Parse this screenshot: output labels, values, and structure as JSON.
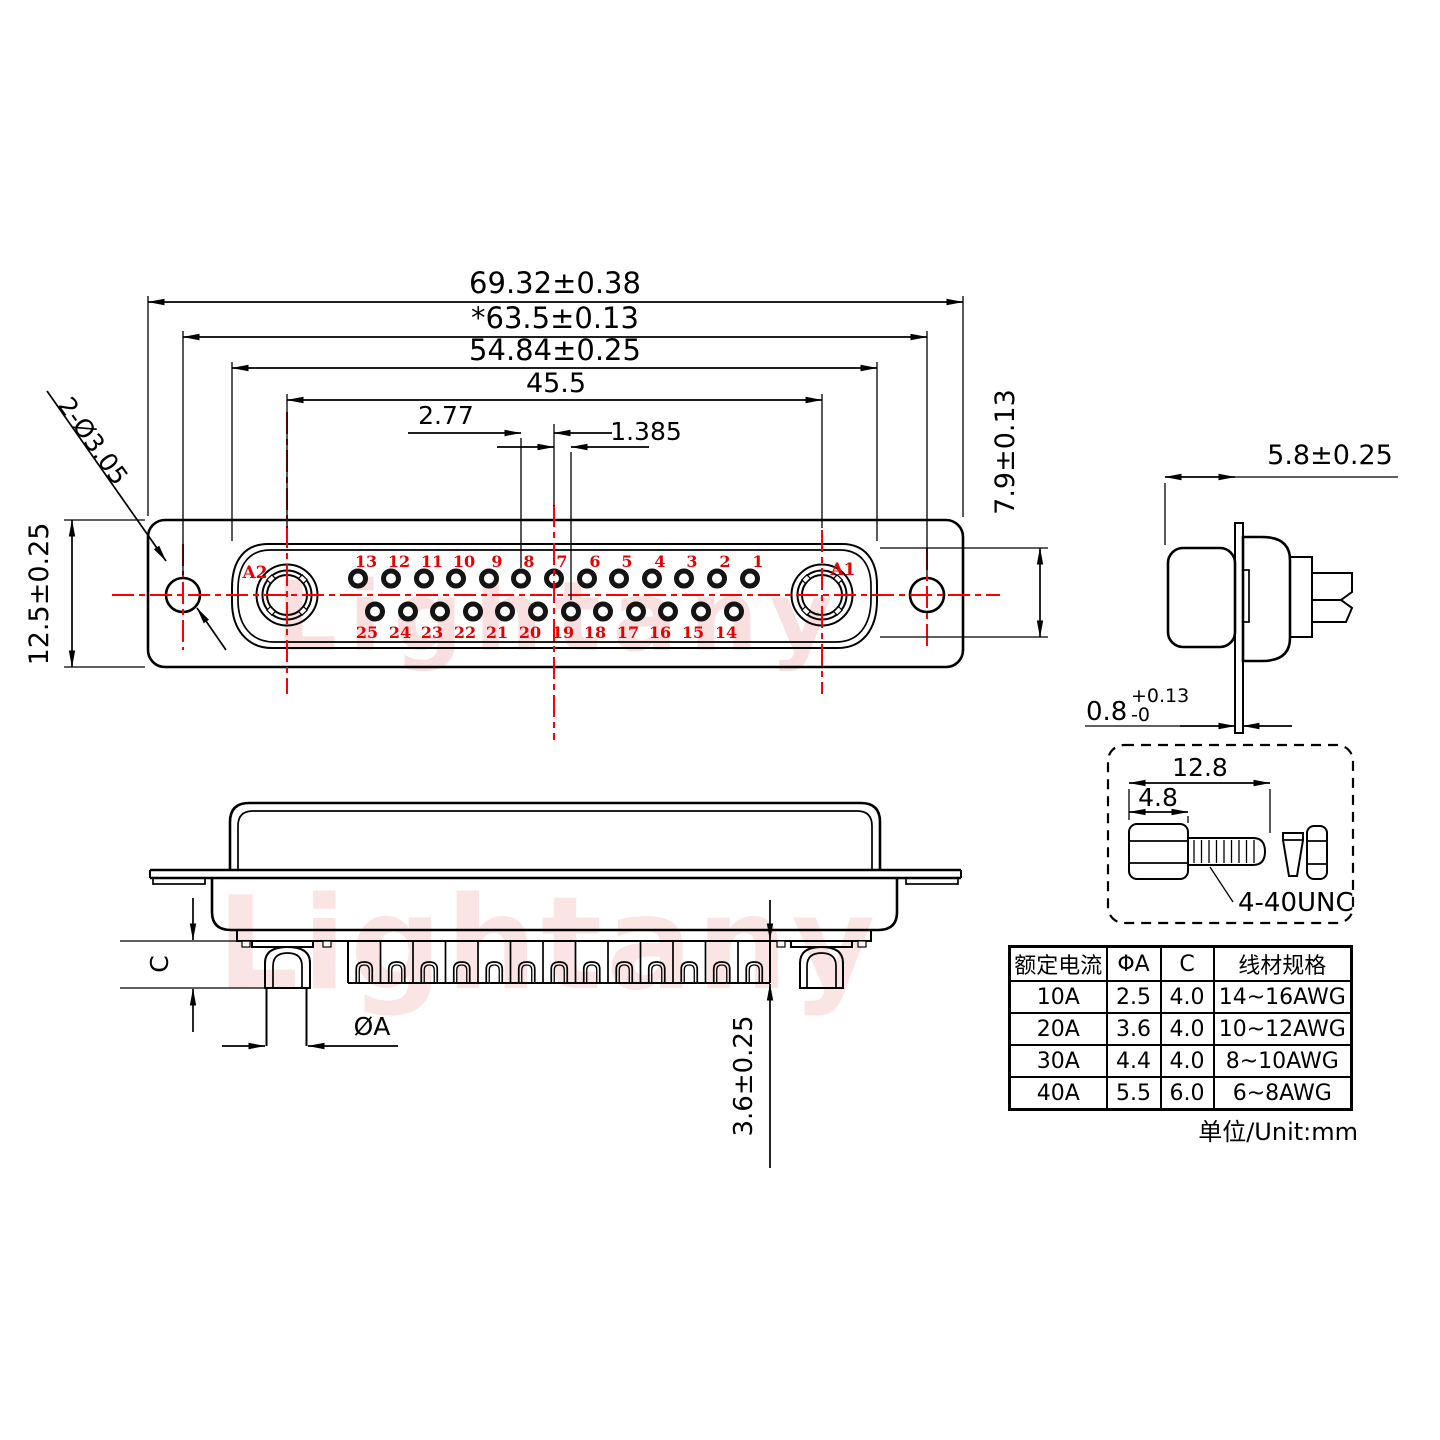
{
  "watermark": {
    "text": "Lightany"
  },
  "front_view": {
    "coax_left": "A2",
    "coax_right": "A1",
    "pins_top": [
      "13",
      "12",
      "11",
      "10",
      "9",
      "8",
      "7",
      "6",
      "5",
      "4",
      "3",
      "2",
      "1"
    ],
    "pins_bottom": [
      "25",
      "24",
      "23",
      "22",
      "21",
      "20",
      "19",
      "18",
      "17",
      "16",
      "15",
      "14"
    ],
    "dims": {
      "overall_width": "69.32±0.38",
      "mount_span": "*63.5±0.13",
      "cutout_width": "54.84±0.25",
      "coax_span": "45.5",
      "pin_pitch": "2.77",
      "row_offset": "1.385",
      "body_height": "12.5±0.25",
      "cutout_height": "7.9±0.13",
      "mount_holes": "2-Ø3.05"
    }
  },
  "side_view": {
    "dims": {
      "front_depth": "5.8±0.25",
      "panel_thickness": "0.8",
      "panel_tol_upper": "+0.13",
      "panel_tol_lower": "-0"
    }
  },
  "section_view": {
    "dims": {
      "barrel_label": "C",
      "tail_dia_label": "ØA",
      "pin_protrusion": "3.6±0.25"
    }
  },
  "screw_detail": {
    "dims": {
      "overall_length": "12.8",
      "head_length": "4.8"
    },
    "thread_spec": "4-40UNC"
  },
  "spec_table": {
    "headers": [
      "额定电流",
      "ΦA",
      "C",
      "线材规格"
    ],
    "rows": [
      [
        "10A",
        "2.5",
        "4.0",
        "14~16AWG"
      ],
      [
        "20A",
        "3.6",
        "4.0",
        "10~12AWG"
      ],
      [
        "30A",
        "4.4",
        "4.0",
        "8~10AWG"
      ],
      [
        "40A",
        "5.5",
        "6.0",
        "6~8AWG"
      ]
    ],
    "unit_note": "单位/Unit:mm"
  }
}
